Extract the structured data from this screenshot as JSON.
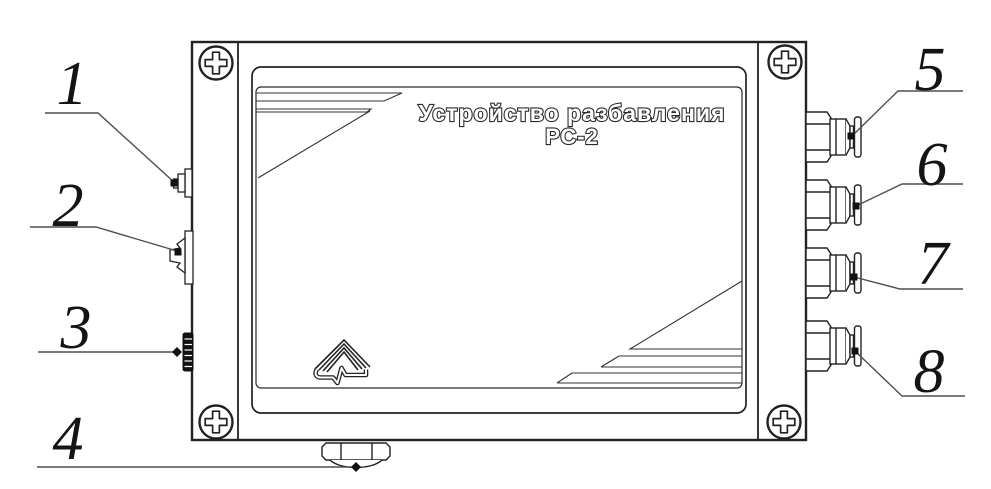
{
  "diagram": {
    "device_label": {
      "line1": "Устройство разбавления",
      "line2": "РС-2"
    },
    "callouts": [
      {
        "label": "1"
      },
      {
        "label": "2"
      },
      {
        "label": "3"
      },
      {
        "label": "4"
      },
      {
        "label": "5"
      },
      {
        "label": "6"
      },
      {
        "label": "7"
      },
      {
        "label": "8"
      }
    ]
  },
  "colors": {
    "line": "#222222",
    "leader": "#4d4d4d",
    "background": "#ffffff"
  }
}
